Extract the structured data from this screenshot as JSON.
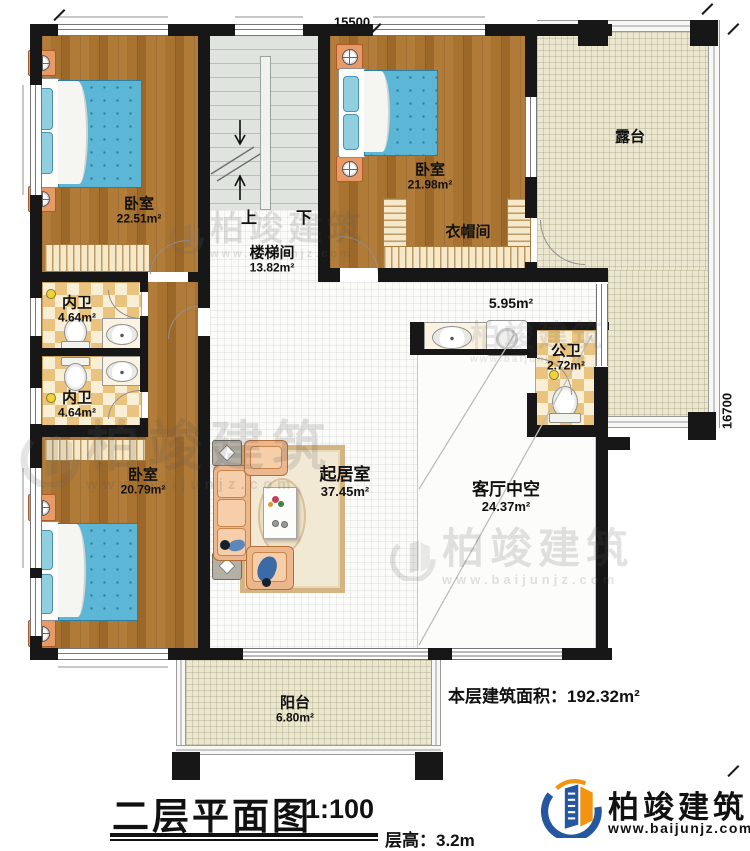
{
  "dimensions": {
    "top": "15500",
    "right": "16700"
  },
  "rooms": {
    "bedroom1": {
      "name": "卧室",
      "area": "22.51m²"
    },
    "stairwell": {
      "name": "楼梯间",
      "area": "13.82m²"
    },
    "bedroom2": {
      "name": "卧室",
      "area": "21.98m²"
    },
    "cloakroom": {
      "name": "衣帽间"
    },
    "terrace": {
      "name": "露台"
    },
    "hallway": {
      "area": "5.95m²"
    },
    "public_bath": {
      "name": "公卫",
      "area": "2.72m²"
    },
    "inner_bath1": {
      "name": "内卫",
      "area": "4.64m²"
    },
    "inner_bath2": {
      "name": "内卫",
      "area": "4.64m²"
    },
    "bedroom3": {
      "name": "卧室",
      "area": "20.79m²"
    },
    "living": {
      "name": "起居室",
      "area": "37.45m²"
    },
    "void": {
      "name": "客厅中空",
      "area": "24.37m²"
    },
    "balcony": {
      "name": "阳台",
      "area": "6.80m²"
    }
  },
  "stairs": {
    "up": "上",
    "down": "下"
  },
  "footer": {
    "area_note": "本层建筑面积：192.32m²",
    "title": "二层平面图",
    "scale": "1:100",
    "floor_height": "层高：3.2m"
  },
  "brand": {
    "name": "柏竣建筑",
    "site": "www.baijunjz.com"
  },
  "watermark": {
    "text": "柏竣建筑",
    "site": "www.baijunjz.com"
  },
  "colors": {
    "wall": "#171717",
    "wood": "#a9732f",
    "bed_blue": "#5cb6d6",
    "checker_tan": "#eac47f",
    "terrace_cream": "#ebe7d0",
    "brand_blue": "#2457a0",
    "brand_orange": "#f29410"
  }
}
